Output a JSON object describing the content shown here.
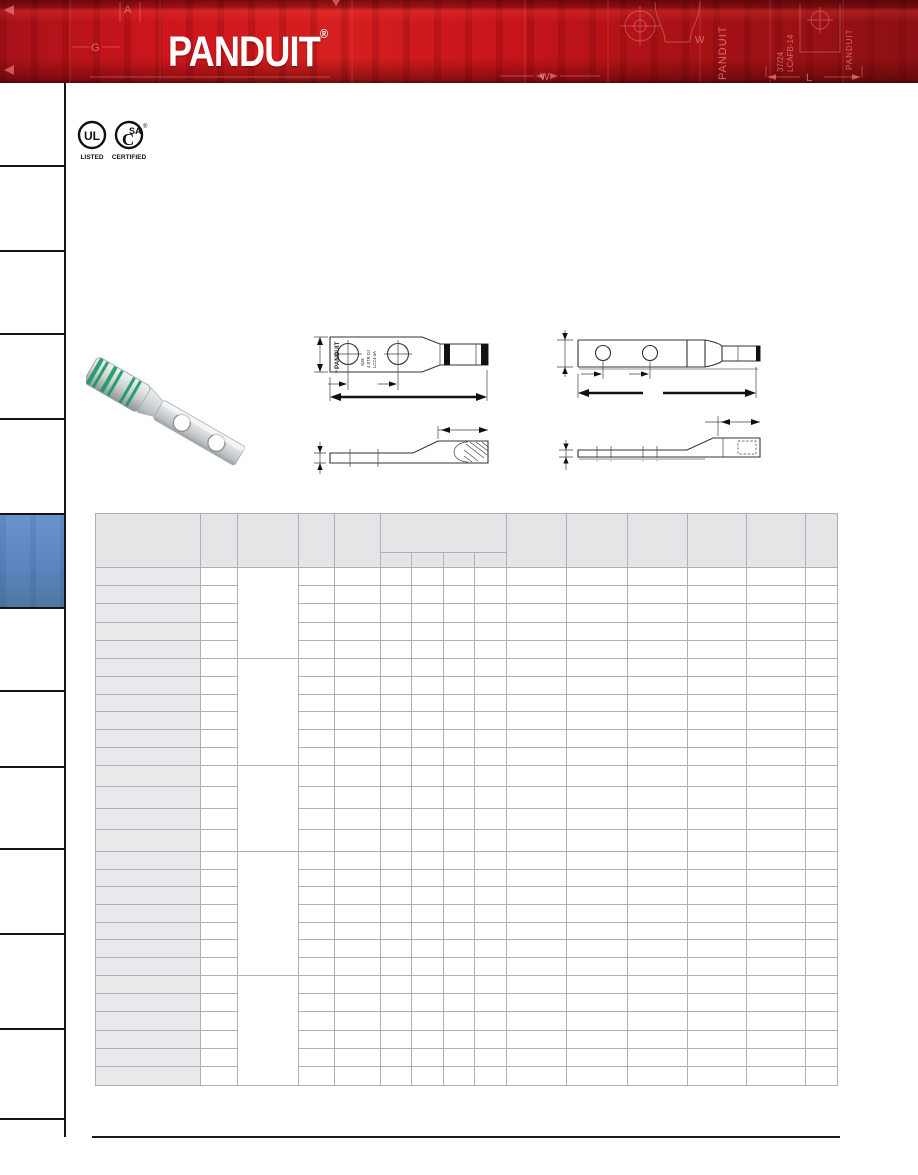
{
  "banner": {
    "logo_text": "PANDUIT",
    "registered_mark": "®",
    "motif": {
      "letter_a": "A",
      "letter_g": "G",
      "letter_w": "W",
      "letter_l": "L",
      "vertical_text_1": "PANDUIT",
      "vertical_text_2a": "37/24",
      "vertical_text_2b": "LCAFB-14",
      "vertical_text_3": "PANDUIT"
    }
  },
  "certifications": {
    "ul_mark": "UL",
    "ul_label": "LISTED",
    "csa_c": "C",
    "csa_mark": "SA",
    "csa_registered": "®",
    "csa_label": "CERTIFIED"
  },
  "drawing_center": {
    "brand_vertical": "PANDUIT",
    "registered": "®",
    "stamp_line_1": "N29",
    "stamp_line_2": "4 STR DJ",
    "stamp_line_3": "LCC4-4A"
  },
  "table": {
    "header_cells": [
      "",
      "",
      "",
      "",
      ""
    ],
    "group_header": "",
    "group_subcells": [
      "",
      "",
      "",
      ""
    ],
    "right_header_cells": [
      "",
      "",
      "",
      "",
      "",
      ""
    ],
    "groups": [
      {
        "rows": 5
      },
      {
        "rows": 6
      },
      {
        "rows": 4
      },
      {
        "rows": 7
      },
      {
        "rows": 6
      }
    ]
  },
  "sidebar": {
    "section_count": 13,
    "active_section_index": 5
  },
  "colors": {
    "banner_red": "#c8161d",
    "banner_red_dark": "#8a1013",
    "active_tab_blue": "#5b85c0",
    "table_header_gray": "#e4e5e7",
    "row_label_gray": "#e9eaeb",
    "grid_line": "#aeb1b3",
    "product_band_green": "#169a62"
  }
}
